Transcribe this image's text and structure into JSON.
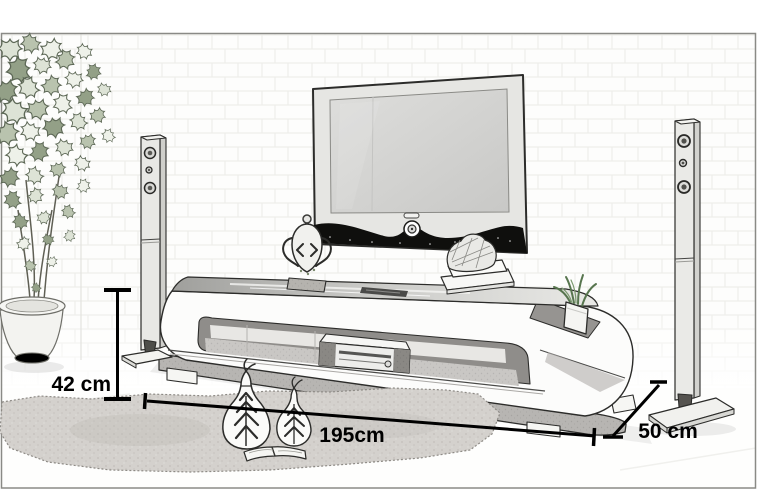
{
  "scene": {
    "style": "pencil-sketch product drawing",
    "subject": "TV stand with wall-mounted TV, two tower speakers, potted plant, rug and decor"
  },
  "annotations": {
    "height_label": "42 cm",
    "width_label": "195cm",
    "depth_label": "50 cm"
  },
  "objects": [
    "wall-mounted-tv",
    "tv-stand",
    "glass-top",
    "media-player",
    "left-tower-speaker",
    "right-tower-speaker",
    "speaker-floor-plate",
    "potted-plant",
    "plant-pot",
    "shelf-plant",
    "ornament",
    "books-with-bowl",
    "remote-control",
    "rug",
    "decor-vase-large",
    "decor-vase-small",
    "open-book"
  ],
  "colors": {
    "background": "#ffffff",
    "frame_border": "#8a8a86",
    "sketch_line": "#2c2c2a",
    "annotation_text": "#000000",
    "tv_screen": "#d5d5d3",
    "tv_band": "#0f0f0d",
    "stand_base": "#b7b5b2",
    "rug": "#d4d1cd",
    "foliage": "#6d7a64"
  }
}
